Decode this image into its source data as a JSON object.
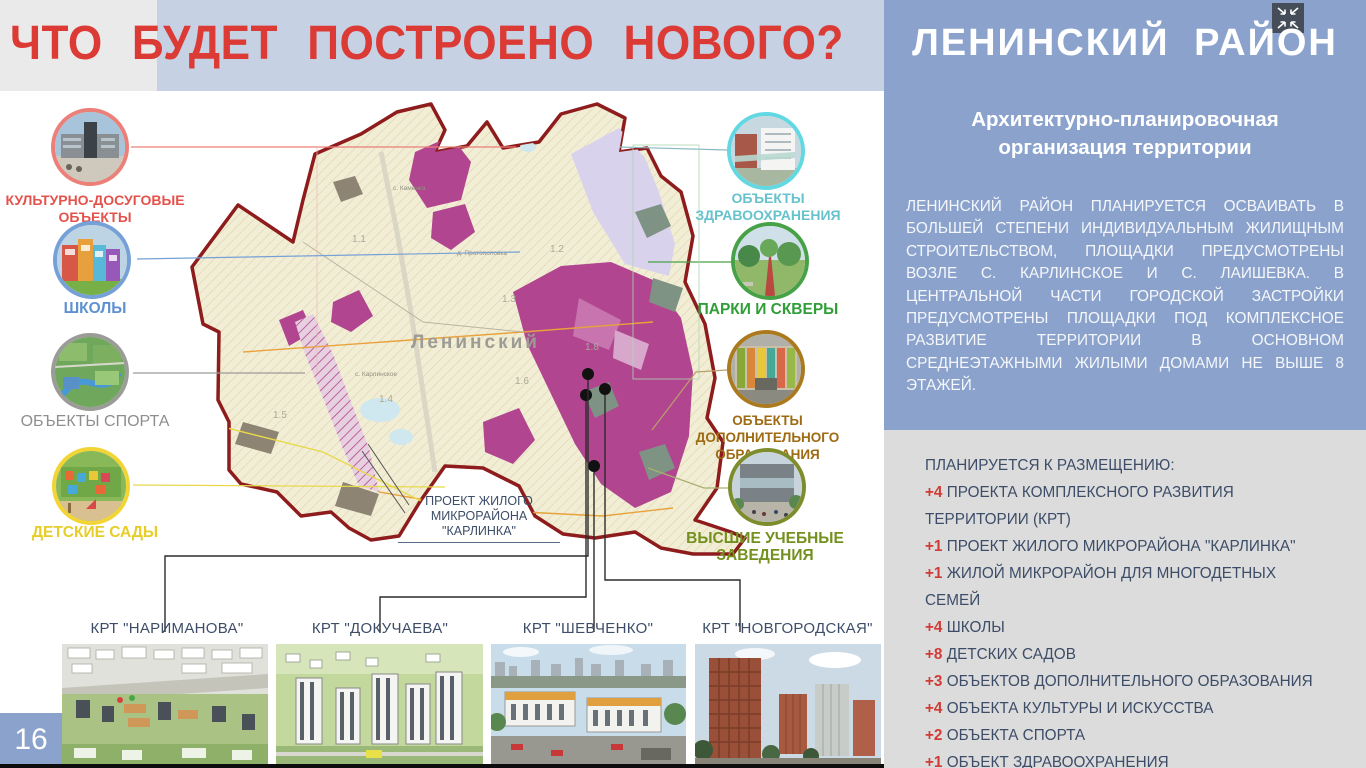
{
  "page": {
    "number": "16",
    "title": "ЧТО БУДЕТ ПОСТРОЕНО НОВОГО?"
  },
  "sidebar": {
    "title": "ЛЕНИНСКИЙ РАЙОН",
    "subtitle": "Архитектурно-планировочная организация территории",
    "paragraph": "ЛЕНИНСКИЙ РАЙОН ПЛАНИРУЕТСЯ ОСВАИВАТЬ В БОЛЬШЕЙ СТЕПЕНИ ИНДИВИДУАЛЬНЫМ ЖИЛИЩНЫМ СТРОИТЕЛЬСТВОМ, ПЛОЩАДКИ ПРЕДУСМОТРЕНЫ ВОЗЛЕ С. КАРЛИНСКОЕ И С. ЛАИШЕВКА. В ЦЕНТРАЛЬНОЙ ЧАСТИ ГОРОДСКОЙ ЗАСТРОЙКИ ПРЕДУСМОТРЕНЫ ПЛОЩАДКИ ПОД КОМПЛЕКСНОЕ РАЗВИТИЕ ТЕРРИТОРИИ В ОСНОВНОМ СРЕДНЕЭТАЖНЫМИ ЖИЛЫМИ ДОМАМИ НЕ ВЫШЕ 8 ЭТАЖЕЙ.",
    "plan": {
      "heading": "ПЛАНИРУЕТСЯ К РАЗМЕЩЕНИЮ:",
      "items": [
        {
          "count": "+4",
          "label": " ПРОЕКТА КОМПЛЕКСНОГО РАЗВИТИЯ ТЕРРИТОРИИ (КРТ)"
        },
        {
          "count": "+1",
          "label": " ПРОЕКТ ЖИЛОГО МИКРОРАЙОНА \"КАРЛИНКА\""
        },
        {
          "count": "+1",
          "label": " ЖИЛОЙ МИКРОРАЙОН ДЛЯ МНОГОДЕТНЫХ СЕМЕЙ"
        },
        {
          "count": "+4",
          "label": " ШКОЛЫ"
        },
        {
          "count": "+8",
          "label": " ДЕТСКИХ САДОВ"
        },
        {
          "count": "+3",
          "label": " ОБЪЕКТОВ ДОПОЛНИТЕЛЬНОГО ОБРАЗОВАНИЯ"
        },
        {
          "count": "+4",
          "label": " ОБЪЕКТА КУЛЬТУРЫ И ИСКУССТВА"
        },
        {
          "count": "+2",
          "label": " ОБЪЕКТА СПОРТА"
        },
        {
          "count": "+1",
          "label": " ОБЪЕКТ ЗДРАВООХРАНЕНИЯ"
        }
      ]
    }
  },
  "legend_left": [
    {
      "label": "КУЛЬТУРНО-ДОСУГОВЫЕ ОБЪЕКТЫ",
      "color": "#ec7f78",
      "text_color": "#e4524c"
    },
    {
      "label": "ШКОЛЫ",
      "color": "#76a0d8",
      "text_color": "#5e91d2"
    },
    {
      "label": "ОБЪЕКТЫ СПОРТА",
      "color": "#9b9b98",
      "text_color": "#8e8e8c"
    },
    {
      "label": "ДЕТСКИЕ САДЫ",
      "color": "#f2d535",
      "text_color": "#e6cd28"
    }
  ],
  "legend_right": [
    {
      "label": "ОБЪЕКТЫ ЗДРАВООХРАНЕНИЯ",
      "color": "#62d8e2",
      "text_color": "#66c2cc"
    },
    {
      "label": "ПАРКИ И СКВЕРЫ",
      "color": "#47a247",
      "text_color": "#2f9e38"
    },
    {
      "label": "ОБЪЕКТЫ ДОПОЛНИТЕЛЬНОГО ОБРАЗОВАНИЯ",
      "color": "#ab7a1f",
      "text_color": "#9e6a12"
    },
    {
      "label": "ВЫСШИЕ УЧЕБНЫЕ ЗАВЕДЕНИЯ",
      "color": "#7e8d2c",
      "text_color": "#74901e"
    }
  ],
  "map": {
    "district_label": "Ленинский",
    "annotation_line1": "ПРОЕКТ ЖИЛОГО",
    "annotation_line2": "МИКРОРАЙОНА \"КАРЛИНКА\"",
    "zones": [
      "1.1",
      "1.2",
      "1.3",
      "1.4",
      "1.5",
      "1.6",
      "1.8"
    ],
    "villages": [
      "с. Каменка",
      "д. Протопоповка",
      "с. Карлинское"
    ]
  },
  "projects": [
    {
      "label": "КРТ \"НАРИМАНОВА\""
    },
    {
      "label": "КРТ \"ДОКУЧАЕВА\""
    },
    {
      "label": "КРТ \"ШЕВЧЕНКО\""
    },
    {
      "label": "КРТ \"НОВГОРОДСКАЯ\""
    }
  ],
  "colors": {
    "accent_red": "#dc3a35",
    "sidebar_blue": "#8ba3cc",
    "band_blue": "#c6d1e4",
    "panel_gray": "#dcdcdc",
    "text_dark": "#3d4d68"
  }
}
